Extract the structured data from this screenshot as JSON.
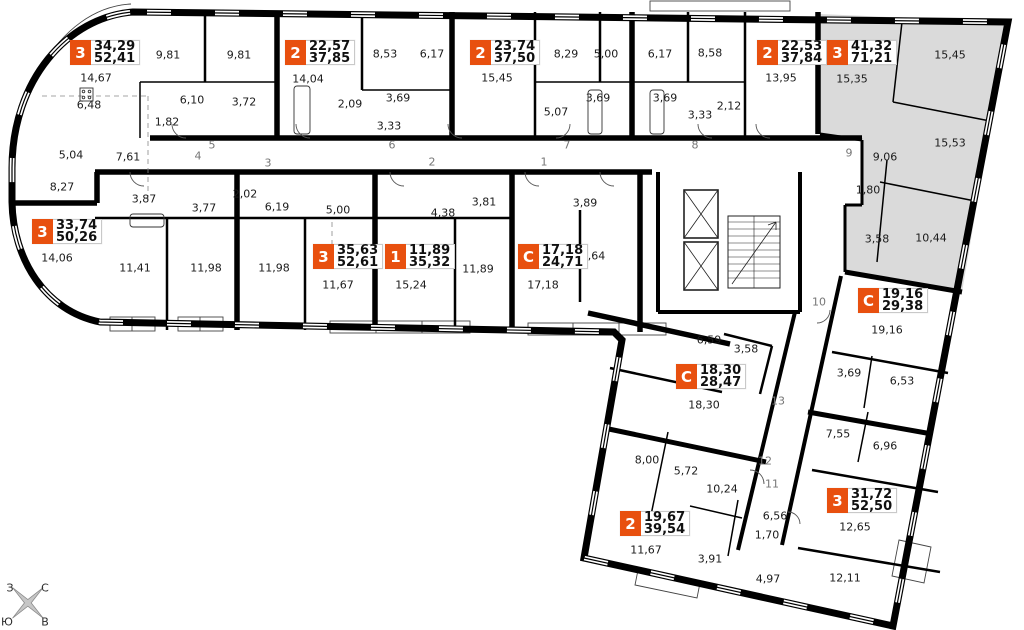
{
  "title": "floor-plan",
  "colors": {
    "badge_orange": "#e8500f",
    "sold_gray": "#dadada",
    "wall": "#000000"
  },
  "apartments": [
    {
      "badge": "3",
      "living": "34,29",
      "total": "52,41",
      "x": 70,
      "y": 40
    },
    {
      "badge": "2",
      "living": "22,57",
      "total": "37,85",
      "x": 285,
      "y": 40
    },
    {
      "badge": "2",
      "living": "23,74",
      "total": "37,50",
      "x": 470,
      "y": 40
    },
    {
      "badge": "2",
      "living": "22,53",
      "total": "37,84",
      "x": 757,
      "y": 40
    },
    {
      "badge": "3",
      "living": "41,32",
      "total": "71,21",
      "x": 827,
      "y": 40
    },
    {
      "badge": "3",
      "living": "33,74",
      "total": "50,26",
      "x": 32,
      "y": 219
    },
    {
      "badge": "3",
      "living": "35,63",
      "total": "52,61",
      "x": 313,
      "y": 244
    },
    {
      "badge": "1",
      "living": "11,89",
      "total": "35,32",
      "x": 385,
      "y": 244
    },
    {
      "badge": "С",
      "living": "17,18",
      "total": "24,71",
      "x": 518,
      "y": 244
    },
    {
      "badge": "С",
      "living": "19,16",
      "total": "29,38",
      "x": 858,
      "y": 288
    },
    {
      "badge": "С",
      "living": "18,30",
      "total": "28,47",
      "x": 676,
      "y": 364
    },
    {
      "badge": "2",
      "living": "19,67",
      "total": "39,54",
      "x": 620,
      "y": 511
    },
    {
      "badge": "3",
      "living": "31,72",
      "total": "52,50",
      "x": 827,
      "y": 488
    }
  ],
  "rooms": [
    {
      "label": "9,81",
      "x": 168,
      "y": 55
    },
    {
      "label": "9,81",
      "x": 239,
      "y": 55
    },
    {
      "label": "14,67",
      "x": 96,
      "y": 78
    },
    {
      "label": "6,48",
      "x": 89,
      "y": 105
    },
    {
      "label": "6,10",
      "x": 192,
      "y": 100
    },
    {
      "label": "1,82",
      "x": 167,
      "y": 122
    },
    {
      "label": "3,72",
      "x": 244,
      "y": 102
    },
    {
      "label": "5,04",
      "x": 71,
      "y": 155
    },
    {
      "label": "7,61",
      "x": 128,
      "y": 157
    },
    {
      "label": "8,27",
      "x": 62,
      "y": 187
    },
    {
      "label": "14,04",
      "x": 308,
      "y": 79
    },
    {
      "label": "8,53",
      "x": 385,
      "y": 54
    },
    {
      "label": "6,17",
      "x": 432,
      "y": 54
    },
    {
      "label": "2,09",
      "x": 350,
      "y": 104
    },
    {
      "label": "3,69",
      "x": 398,
      "y": 98
    },
    {
      "label": "3,33",
      "x": 389,
      "y": 126
    },
    {
      "label": "15,45",
      "x": 497,
      "y": 78
    },
    {
      "label": "8,29",
      "x": 566,
      "y": 54
    },
    {
      "label": "5,00",
      "x": 606,
      "y": 54
    },
    {
      "label": "6,17",
      "x": 660,
      "y": 54
    },
    {
      "label": "5,07",
      "x": 556,
      "y": 112
    },
    {
      "label": "3,69",
      "x": 598,
      "y": 98
    },
    {
      "label": "3,69",
      "x": 665,
      "y": 98
    },
    {
      "label": "3,33",
      "x": 700,
      "y": 115
    },
    {
      "label": "2,12",
      "x": 729,
      "y": 106
    },
    {
      "label": "8,58",
      "x": 710,
      "y": 53
    },
    {
      "label": "13,95",
      "x": 781,
      "y": 78
    },
    {
      "label": "15,35",
      "x": 852,
      "y": 79
    },
    {
      "label": "15,45",
      "x": 950,
      "y": 55
    },
    {
      "label": "15,53",
      "x": 950,
      "y": 143
    },
    {
      "label": "9,06",
      "x": 885,
      "y": 157
    },
    {
      "label": "1,80",
      "x": 868,
      "y": 190
    },
    {
      "label": "3,58",
      "x": 877,
      "y": 239
    },
    {
      "label": "10,44",
      "x": 931,
      "y": 238
    },
    {
      "label": "3,87",
      "x": 144,
      "y": 199
    },
    {
      "label": "3,77",
      "x": 204,
      "y": 208
    },
    {
      "label": "2,02",
      "x": 245,
      "y": 194
    },
    {
      "label": "6,19",
      "x": 277,
      "y": 207
    },
    {
      "label": "5,00",
      "x": 338,
      "y": 210
    },
    {
      "label": "14,06",
      "x": 57,
      "y": 258
    },
    {
      "label": "11,41",
      "x": 135,
      "y": 268
    },
    {
      "label": "11,98",
      "x": 206,
      "y": 268
    },
    {
      "label": "11,98",
      "x": 274,
      "y": 268
    },
    {
      "label": "11,67",
      "x": 338,
      "y": 285
    },
    {
      "label": "15,24",
      "x": 411,
      "y": 285
    },
    {
      "label": "4,38",
      "x": 443,
      "y": 213
    },
    {
      "label": "3,81",
      "x": 484,
      "y": 202
    },
    {
      "label": "11,89",
      "x": 478,
      "y": 269
    },
    {
      "label": "17,18",
      "x": 543,
      "y": 285
    },
    {
      "label": "3,89",
      "x": 585,
      "y": 203
    },
    {
      "label": "3,64",
      "x": 593,
      "y": 256
    },
    {
      "label": "19,16",
      "x": 887,
      "y": 330
    },
    {
      "label": "6,59",
      "x": 709,
      "y": 340
    },
    {
      "label": "3,58",
      "x": 746,
      "y": 349
    },
    {
      "label": "18,30",
      "x": 704,
      "y": 405
    },
    {
      "label": "3,69",
      "x": 849,
      "y": 373
    },
    {
      "label": "6,53",
      "x": 902,
      "y": 381
    },
    {
      "label": "7,55",
      "x": 838,
      "y": 434
    },
    {
      "label": "6,96",
      "x": 885,
      "y": 446
    },
    {
      "label": "8,00",
      "x": 647,
      "y": 460
    },
    {
      "label": "5,72",
      "x": 686,
      "y": 471
    },
    {
      "label": "10,24",
      "x": 722,
      "y": 489
    },
    {
      "label": "11,67",
      "x": 646,
      "y": 550
    },
    {
      "label": "3,91",
      "x": 710,
      "y": 559
    },
    {
      "label": "6,56",
      "x": 775,
      "y": 516
    },
    {
      "label": "1,70",
      "x": 767,
      "y": 535
    },
    {
      "label": "4,97",
      "x": 768,
      "y": 579
    },
    {
      "label": "12,65",
      "x": 855,
      "y": 527
    },
    {
      "label": "12,11",
      "x": 845,
      "y": 578
    }
  ],
  "halls": [
    {
      "label": "5",
      "x": 212,
      "y": 145
    },
    {
      "label": "4",
      "x": 198,
      "y": 156
    },
    {
      "label": "3",
      "x": 268,
      "y": 163
    },
    {
      "label": "6",
      "x": 392,
      "y": 145
    },
    {
      "label": "2",
      "x": 432,
      "y": 162
    },
    {
      "label": "1",
      "x": 544,
      "y": 162
    },
    {
      "label": "7",
      "x": 567,
      "y": 145
    },
    {
      "label": "8",
      "x": 695,
      "y": 145
    },
    {
      "label": "9",
      "x": 849,
      "y": 153
    },
    {
      "label": "10",
      "x": 819,
      "y": 302
    },
    {
      "label": "13",
      "x": 778,
      "y": 401
    },
    {
      "label": "12",
      "x": 765,
      "y": 461
    },
    {
      "label": "11",
      "x": 772,
      "y": 484
    }
  ],
  "compass": {
    "points": [
      {
        "label": "З",
        "x": 10,
        "y": 588
      },
      {
        "label": "С",
        "x": 45,
        "y": 588
      },
      {
        "label": "Ю",
        "x": 7,
        "y": 622
      },
      {
        "label": "В",
        "x": 45,
        "y": 622
      }
    ]
  }
}
